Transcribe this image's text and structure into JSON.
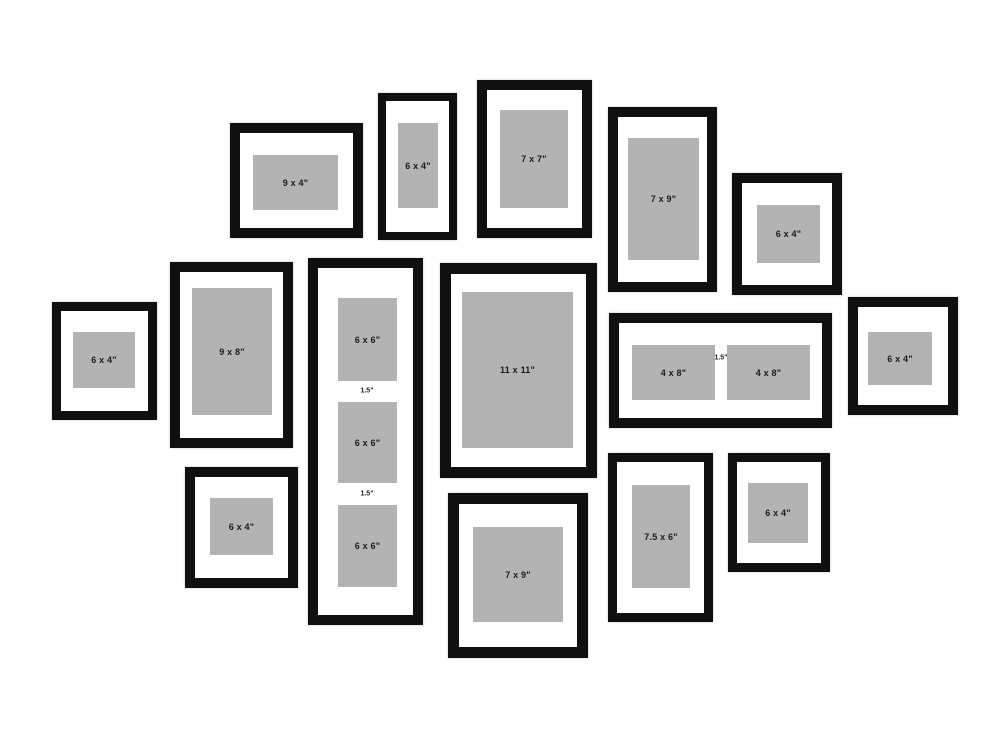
{
  "canvas": {
    "width": 1000,
    "height": 750,
    "background": "#ffffff"
  },
  "colors": {
    "frame_black": "#101010",
    "mat_white": "#ffffff",
    "photo_gray": "#b3b3b3",
    "label_text": "#1b1b1b"
  },
  "frames": [
    {
      "name": "frame-9x4-top",
      "x": 230,
      "y": 123,
      "w": 133,
      "h": 115,
      "border": 10,
      "photos": [
        {
          "x": 253,
          "y": 155,
          "w": 85,
          "h": 55,
          "label": "9 x 4\""
        }
      ]
    },
    {
      "name": "frame-6x4-top-portrait",
      "x": 378,
      "y": 93,
      "w": 79,
      "h": 147,
      "border": 8,
      "photos": [
        {
          "x": 398,
          "y": 123,
          "w": 40,
          "h": 85,
          "label": "6 x 4\""
        }
      ]
    },
    {
      "name": "frame-7x7-top",
      "x": 477,
      "y": 80,
      "w": 115,
      "h": 158,
      "border": 10,
      "photos": [
        {
          "x": 500,
          "y": 110,
          "w": 68,
          "h": 98,
          "label": "7 x 7\""
        }
      ]
    },
    {
      "name": "frame-7x9-top",
      "x": 608,
      "y": 107,
      "w": 109,
      "h": 185,
      "border": 10,
      "photos": [
        {
          "x": 628,
          "y": 138,
          "w": 71,
          "h": 122,
          "label": "7 x 9\""
        }
      ]
    },
    {
      "name": "frame-6x4-top-right",
      "x": 732,
      "y": 173,
      "w": 110,
      "h": 122,
      "border": 10,
      "photos": [
        {
          "x": 757,
          "y": 205,
          "w": 63,
          "h": 58,
          "label": "6 x 4\""
        }
      ]
    },
    {
      "name": "frame-6x4-mid-left",
      "x": 52,
      "y": 302,
      "w": 105,
      "h": 118,
      "border": 9,
      "photos": [
        {
          "x": 73,
          "y": 332,
          "w": 62,
          "h": 56,
          "label": "6 x 4\""
        }
      ]
    },
    {
      "name": "frame-9x8-mid-left",
      "x": 170,
      "y": 262,
      "w": 123,
      "h": 186,
      "border": 10,
      "photos": [
        {
          "x": 192,
          "y": 288,
          "w": 80,
          "h": 127,
          "label": "9 x 8\""
        }
      ]
    },
    {
      "name": "frame-6x6-triple-column",
      "x": 308,
      "y": 258,
      "w": 115,
      "h": 367,
      "border": 10,
      "photos": [
        {
          "x": 338,
          "y": 298,
          "w": 59,
          "h": 83,
          "label": "6 x 6\""
        },
        {
          "x": 338,
          "y": 402,
          "w": 59,
          "h": 81,
          "label": "6 x 6\""
        },
        {
          "x": 338,
          "y": 505,
          "w": 59,
          "h": 82,
          "label": "6 x 6\""
        }
      ],
      "spacers": [
        {
          "x": 367,
          "y": 391,
          "text": "1.5\""
        },
        {
          "x": 367,
          "y": 494,
          "text": "1.5\""
        }
      ]
    },
    {
      "name": "frame-11x11-center",
      "x": 440,
      "y": 263,
      "w": 157,
      "h": 215,
      "border": 11,
      "photos": [
        {
          "x": 462,
          "y": 292,
          "w": 111,
          "h": 156,
          "label": "11 x 11\""
        }
      ]
    },
    {
      "name": "frame-4x8-double",
      "x": 609,
      "y": 313,
      "w": 223,
      "h": 115,
      "border": 10,
      "photos": [
        {
          "x": 632,
          "y": 345,
          "w": 83,
          "h": 55,
          "label": "4 x 8\""
        },
        {
          "x": 727,
          "y": 345,
          "w": 83,
          "h": 55,
          "label": "4 x 8\""
        }
      ],
      "spacers": [
        {
          "x": 721,
          "y": 358,
          "text": "1.5\""
        }
      ]
    },
    {
      "name": "frame-6x4-mid-right",
      "x": 848,
      "y": 297,
      "w": 110,
      "h": 118,
      "border": 10,
      "photos": [
        {
          "x": 868,
          "y": 332,
          "w": 64,
          "h": 53,
          "label": "6 x 4\""
        }
      ]
    },
    {
      "name": "frame-6x4-bottom-left",
      "x": 185,
      "y": 467,
      "w": 113,
      "h": 121,
      "border": 10,
      "photos": [
        {
          "x": 210,
          "y": 498,
          "w": 63,
          "h": 57,
          "label": "6 x 4\""
        }
      ]
    },
    {
      "name": "frame-7x9-bottom-center",
      "x": 448,
      "y": 493,
      "w": 140,
      "h": 165,
      "border": 11,
      "photos": [
        {
          "x": 473,
          "y": 527,
          "w": 90,
          "h": 95,
          "label": "7 x 9\""
        }
      ]
    },
    {
      "name": "frame-7-5x6-bottom",
      "x": 608,
      "y": 453,
      "w": 105,
      "h": 169,
      "border": 9,
      "photos": [
        {
          "x": 632,
          "y": 485,
          "w": 58,
          "h": 103,
          "label": "7.5 x 6\""
        }
      ]
    },
    {
      "name": "frame-6x4-bottom-right",
      "x": 728,
      "y": 453,
      "w": 102,
      "h": 119,
      "border": 9,
      "photos": [
        {
          "x": 748,
          "y": 483,
          "w": 60,
          "h": 60,
          "label": "6 x 4\""
        }
      ]
    }
  ]
}
